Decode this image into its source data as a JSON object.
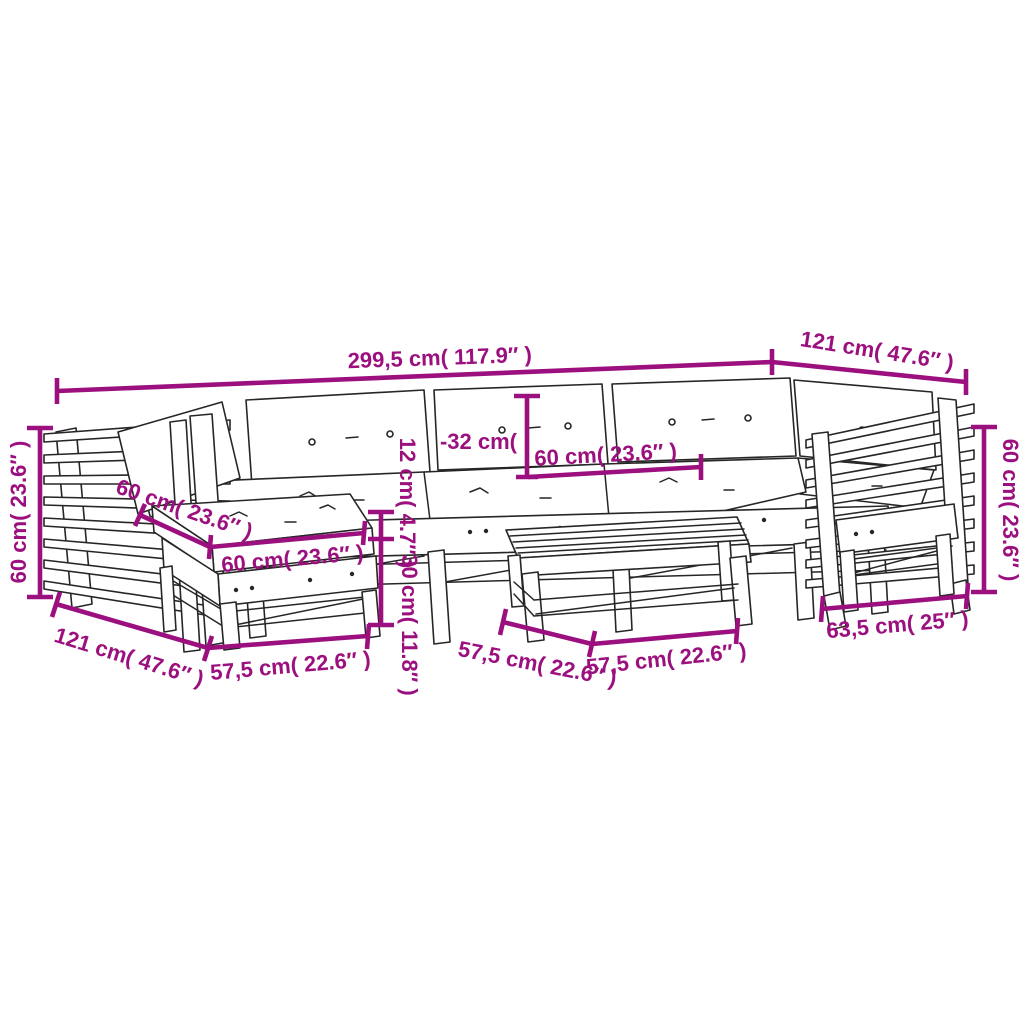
{
  "diagram": {
    "kind": "furniture-dimension-diagram",
    "subject": "garden lounge furniture set line drawing with cushions, ottoman and slatted table",
    "colors": {
      "dimension": "#9B107E",
      "sketch_line": "#262626",
      "background": "#ffffff"
    },
    "dimensions": [
      {
        "id": "overall-width",
        "label": "299,5 cm( 117.9″ )"
      },
      {
        "id": "top-depth",
        "label": "121 cm( 47.6″ )"
      },
      {
        "id": "left-height",
        "label": "60 cm( 23.6″ )"
      },
      {
        "id": "backrest-height",
        "label": "-32 cm("
      },
      {
        "id": "back-cushion-width",
        "label": "60 cm( 23.6″ )"
      },
      {
        "id": "ottoman-cushion-depth",
        "label": "60 cm( 23.6″ )"
      },
      {
        "id": "ottoman-cushion-width",
        "label": "60 cm( 23.6″ )"
      },
      {
        "id": "cushion-thickness",
        "label": "12 cm( 4.7″ )"
      },
      {
        "id": "seat-height",
        "label": "30 cm( 11.8″ )"
      },
      {
        "id": "bottom-left-depth",
        "label": "121 cm( 47.6″ )"
      },
      {
        "id": "ottoman-width",
        "label": "57,5 cm( 22.6″ )"
      },
      {
        "id": "table-width-left",
        "label": "57,5 cm( 22.6″ )"
      },
      {
        "id": "table-width-right",
        "label": "57,5 cm( 22.6″ )"
      },
      {
        "id": "right-depth",
        "label": "63,5 cm( 25″ )"
      },
      {
        "id": "right-height",
        "label": "60 cm( 23.6″ )"
      }
    ]
  }
}
